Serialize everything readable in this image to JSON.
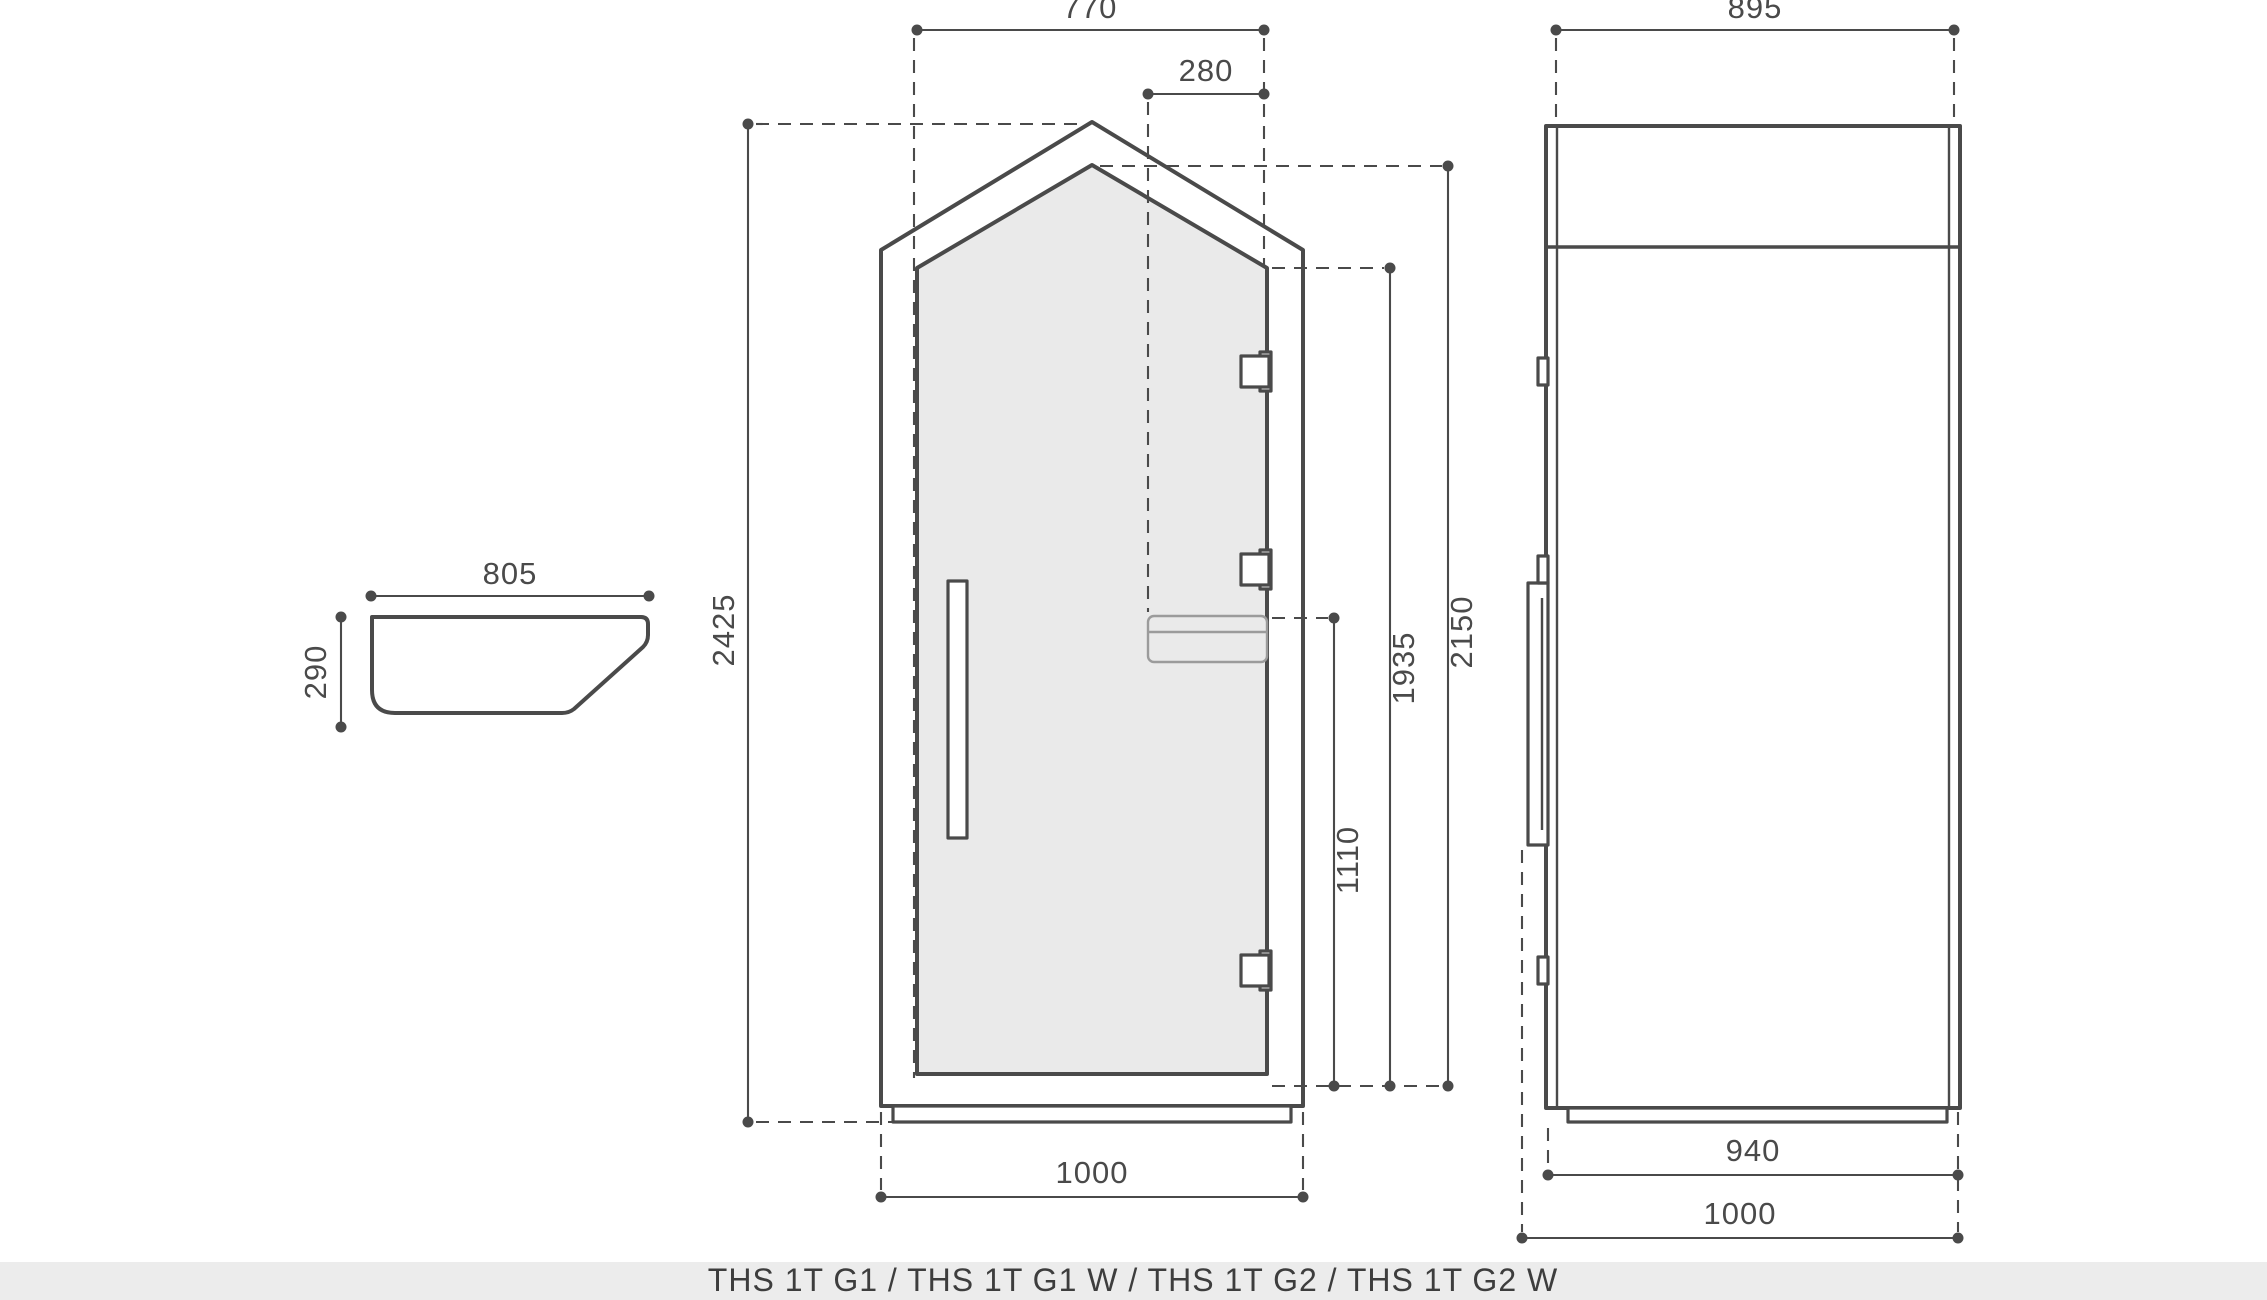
{
  "colors": {
    "line": "#4a4a4a",
    "light_line": "#9b9b9b",
    "glass_fill": "#eaeaea",
    "footer_bg": "#ececec"
  },
  "footer": {
    "models": "THS 1T G1  / THS 1T G1 W / THS 1T G2 / THS 1T G2 W"
  },
  "shelf_profile_view": {
    "width_mm": "805",
    "depth_mm": "290"
  },
  "front_view": {
    "roof_width_mm": "770",
    "reader_offset_mm": "280",
    "overall_height_mm": "2425",
    "glass_apex_height_mm": "2150",
    "door_height_mm": "1935",
    "reader_height_mm": "1110",
    "overall_width_mm": "1000"
  },
  "side_view": {
    "top_depth_mm": "895",
    "base_depth_mm": "940",
    "overall_depth_mm": "1000"
  }
}
